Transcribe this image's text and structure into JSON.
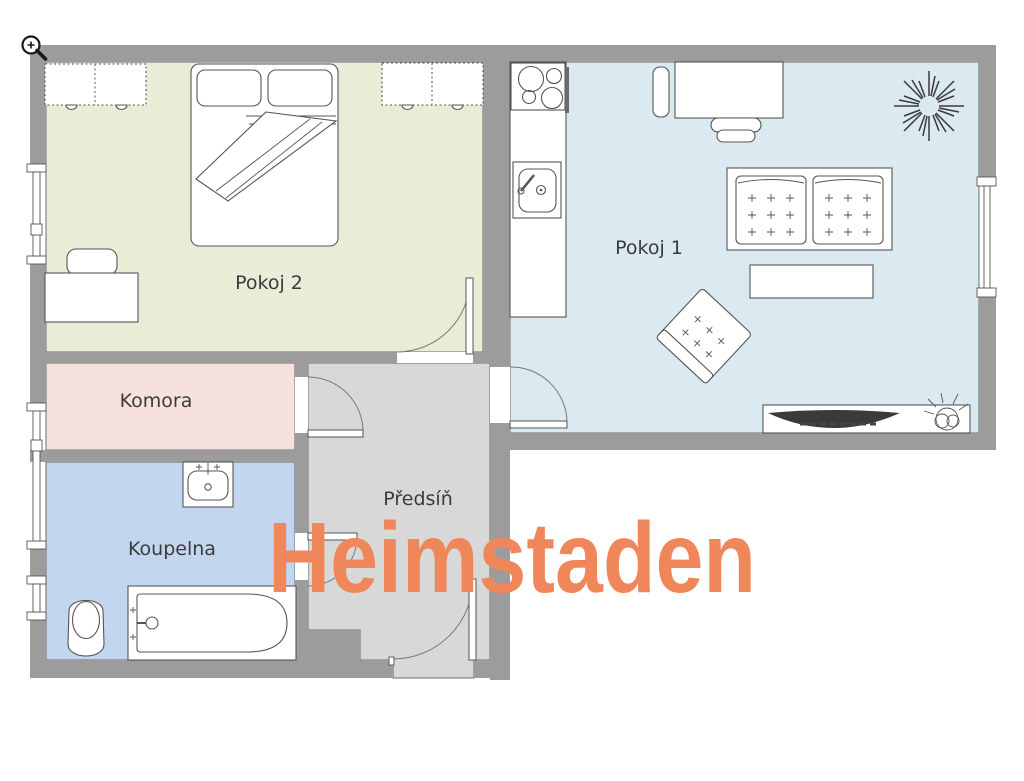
{
  "icons": {
    "zoom_in": "magnifier-plus-icon"
  },
  "watermark": {
    "text": "Heimstaden",
    "color": "#F0875A"
  },
  "palette": {
    "wall": "#9C9C9C",
    "outline": "#5F5F5F",
    "background": "#FFFFFF",
    "tv_screen": "#3a3a3a"
  },
  "rooms": [
    {
      "id": "pokoj2",
      "label": "Pokoj 2",
      "floor_color": "#E8EDD8"
    },
    {
      "id": "pokoj1",
      "label": "Pokoj 1",
      "floor_color": "#DBE9F0"
    },
    {
      "id": "komora",
      "label": "Komora",
      "floor_color": "#F6E1DF"
    },
    {
      "id": "koupelna",
      "label": "Koupelna",
      "floor_color": "#C2D6EF"
    },
    {
      "id": "predsin",
      "label": "Předsíň",
      "floor_color": "#D8D8D8"
    }
  ],
  "furniture": [
    "wardrobe",
    "double-bed",
    "desk",
    "chair",
    "kitchen-stove",
    "kitchen-sink",
    "sofa",
    "coffee-table",
    "armchair",
    "tv-stand",
    "tv",
    "plant",
    "washbasin",
    "toilet",
    "bathtub",
    "door",
    "window"
  ]
}
